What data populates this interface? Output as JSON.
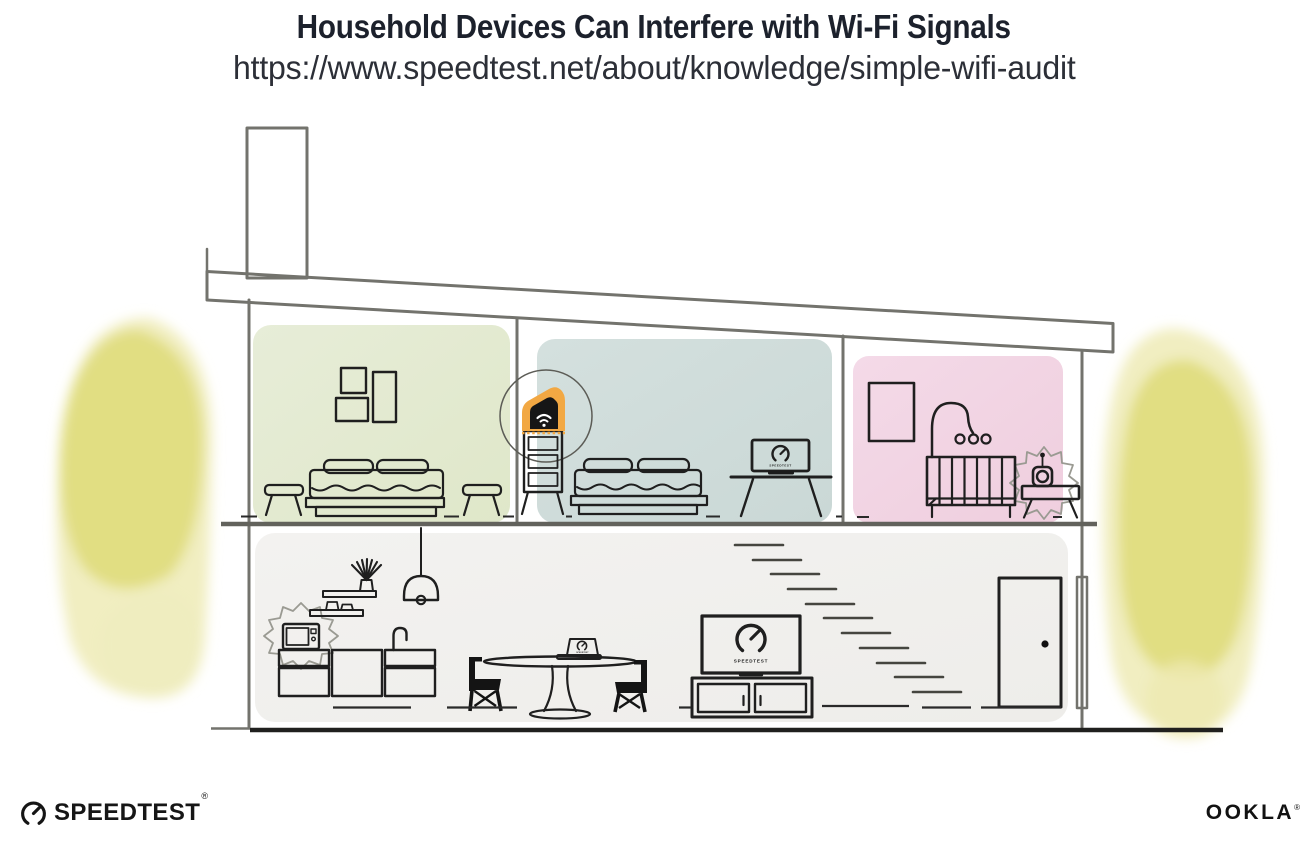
{
  "header": {
    "title": "Household Devices Can Interfere with Wi-Fi Signals",
    "url": "https://www.speedtest.net/about/knowledge/simple-wifi-audit"
  },
  "illustration": {
    "scene": "two-story-house-cross-section",
    "screen_brand_label": "SPEEDTEST",
    "router_accent_color": "#f2a843",
    "interference_sources": [
      "microwave-oven",
      "baby-monitor"
    ],
    "rooms": [
      {
        "id": "bedroom-left",
        "wall_color": "#e4ebd2"
      },
      {
        "id": "bedroom-middle",
        "wall_color": "#cfdcda"
      },
      {
        "id": "nursery",
        "wall_color": "#f2d4e3"
      },
      {
        "id": "living-area",
        "wall_color": "#f1f0ed"
      }
    ],
    "foliage_color": "#e0dc7e",
    "structure_line_color": "#73736d",
    "ink_color": "#1f1f1f"
  },
  "footer": {
    "speedtest_wordmark": "SPEEDTEST",
    "speedtest_registered_mark": "®",
    "ookla_wordmark": "OOKLA",
    "ookla_registered_mark": "®"
  }
}
